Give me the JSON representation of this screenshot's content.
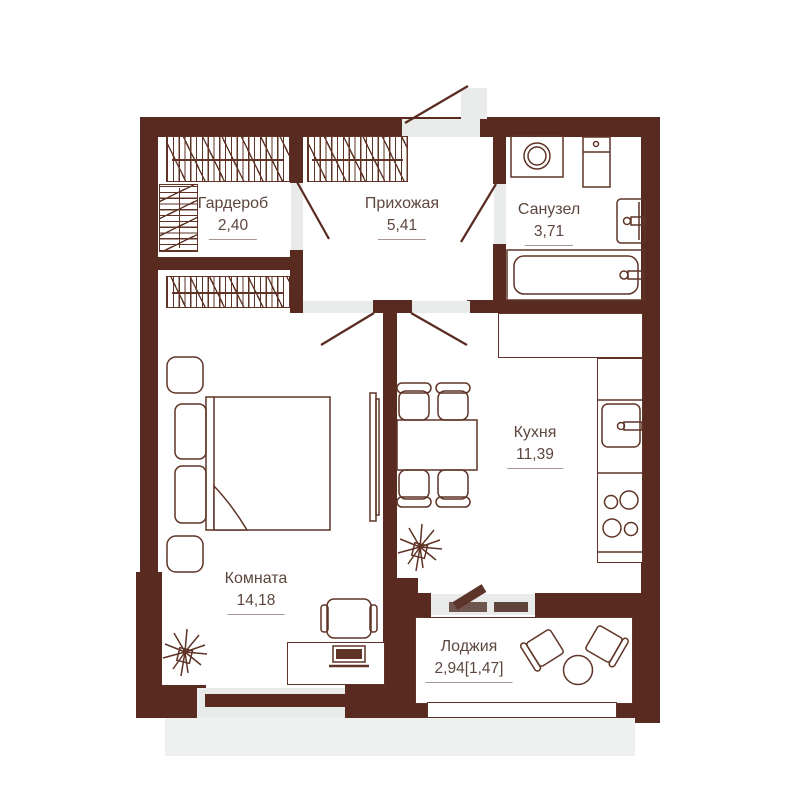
{
  "rooms": [
    {
      "id": "wardrobe",
      "label": "Гардероб",
      "area": "2,40"
    },
    {
      "id": "hallway",
      "label": "Прихожая",
      "area": "5,41"
    },
    {
      "id": "bathroom",
      "label": "Санузел",
      "area": "3,71"
    },
    {
      "id": "kitchen",
      "label": "Кухня",
      "area": "11,39"
    },
    {
      "id": "room",
      "label": "Комната",
      "area": "14,18"
    },
    {
      "id": "loggia",
      "label": "Лоджия",
      "area": "2,94[1,47]"
    }
  ],
  "colors": {
    "wall": "#582a20",
    "line": "#5f3427",
    "text": "#5d463e",
    "opening": "#e9ebeb",
    "slab": "#eff1f1",
    "door_leaf": "#5c3429",
    "threshold_bar": "#6f574f",
    "window_bar": "#5f443b"
  }
}
